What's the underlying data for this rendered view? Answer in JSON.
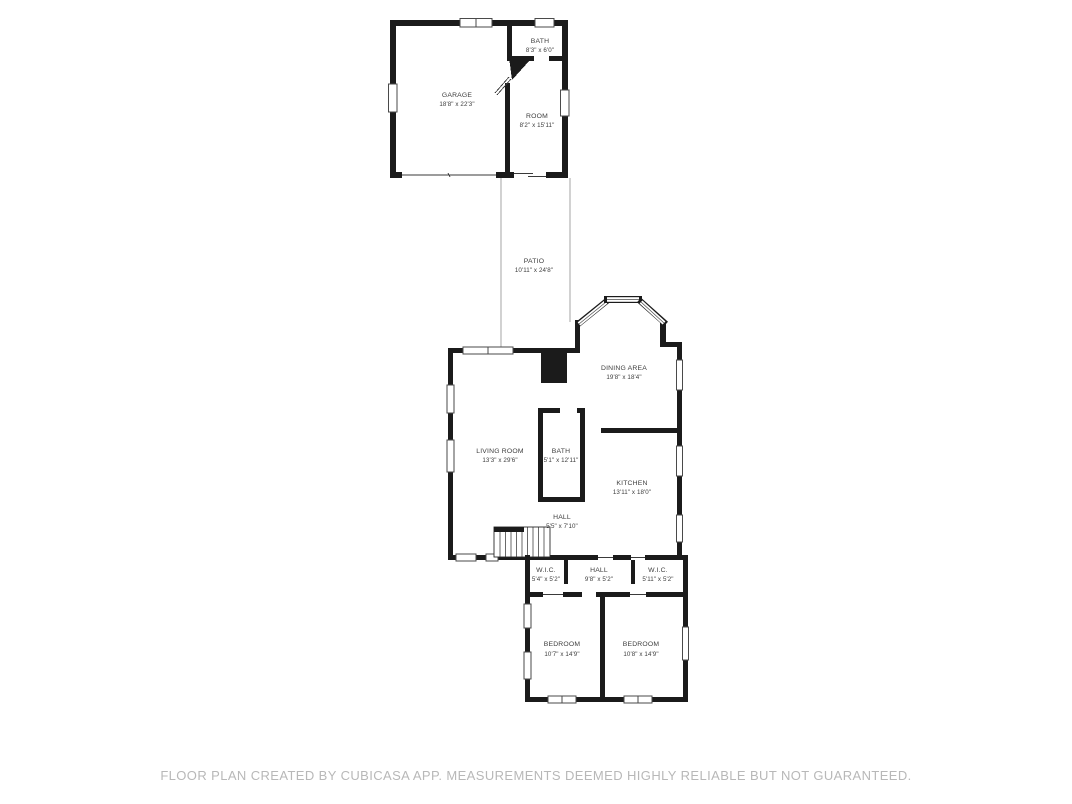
{
  "plan": {
    "rooms": {
      "garage": {
        "name": "GARAGE",
        "dims": "18'8\" x 22'3\""
      },
      "bath_top": {
        "name": "BATH",
        "dims": "8'3\" x 6'0\""
      },
      "room": {
        "name": "ROOM",
        "dims": "8'2\" x 15'11\""
      },
      "patio": {
        "name": "PATIO",
        "dims": "10'11\" x 24'8\""
      },
      "dining": {
        "name": "DINING AREA",
        "dims": "19'8\" x 18'4\""
      },
      "living": {
        "name": "LIVING ROOM",
        "dims": "13'3\" x 29'6\""
      },
      "bath_main": {
        "name": "BATH",
        "dims": "5'1\" x 12'11\""
      },
      "kitchen": {
        "name": "KITCHEN",
        "dims": "13'11\" x 18'0\""
      },
      "hall_upper": {
        "name": "HALL",
        "dims": "5'5\" x 7'10\""
      },
      "wic_left": {
        "name": "W.I.C.",
        "dims": "5'4\" x 5'2\""
      },
      "hall_lower": {
        "name": "HALL",
        "dims": "9'8\" x 5'2\""
      },
      "wic_right": {
        "name": "W.I.C.",
        "dims": "5'11\" x 5'2\""
      },
      "bedroom_left": {
        "name": "BEDROOM",
        "dims": "10'7\" x 14'9\""
      },
      "bedroom_right": {
        "name": "BEDROOM",
        "dims": "10'8\" x 14'9\""
      }
    },
    "colors": {
      "wall": "#1b1b1b",
      "label_text": "#3d3d3d",
      "footer_text": "#b8b8b8",
      "background": "#ffffff"
    }
  },
  "footer": {
    "disclaimer": "FLOOR PLAN CREATED BY CUBICASA APP. MEASUREMENTS DEEMED HIGHLY RELIABLE BUT NOT GUARANTEED."
  }
}
